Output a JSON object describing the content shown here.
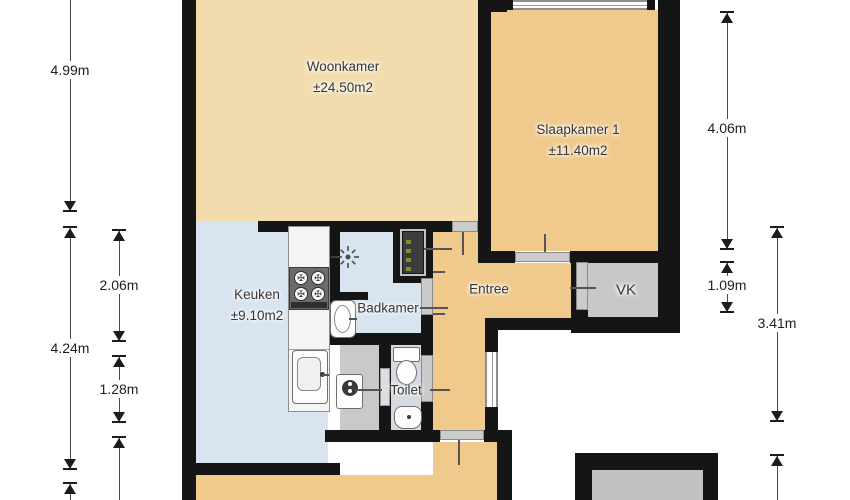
{
  "floorplan": {
    "rooms": {
      "woonkamer": {
        "label": "Woonkamer",
        "area": "±24.50m2"
      },
      "slaapkamer1": {
        "label": "Slaapkamer 1",
        "area": "±11.40m2"
      },
      "keuken": {
        "label": "Keuken",
        "area": "±9.10m2"
      },
      "badkamer": {
        "label": "Badkamer"
      },
      "toilet": {
        "label": "Toilet"
      },
      "entree": {
        "label": "Entree"
      },
      "vk": {
        "label": "VK"
      }
    },
    "dimensions": {
      "left_outer_top": "4.99m",
      "left_outer_bottom": "4.24m",
      "left_inner_top": "2.06m",
      "left_inner_bottom": "1.28m",
      "right_inner_top": "4.06m",
      "right_inner_bottom": "1.09m",
      "right_outer": "3.41m"
    },
    "colors": {
      "living_floor": "#f2dcae",
      "bedroom_entry_floor": "#f0ca8d",
      "kitchen_bath_floor": "#d8e4f0",
      "closet_floor": "#c9c9c9",
      "wc_floor": "#d4dae0",
      "vk_floor": "#c8c8c8",
      "shed_floor": "#c2c2c2",
      "wall": "#151515",
      "background": "#ffffff"
    }
  }
}
